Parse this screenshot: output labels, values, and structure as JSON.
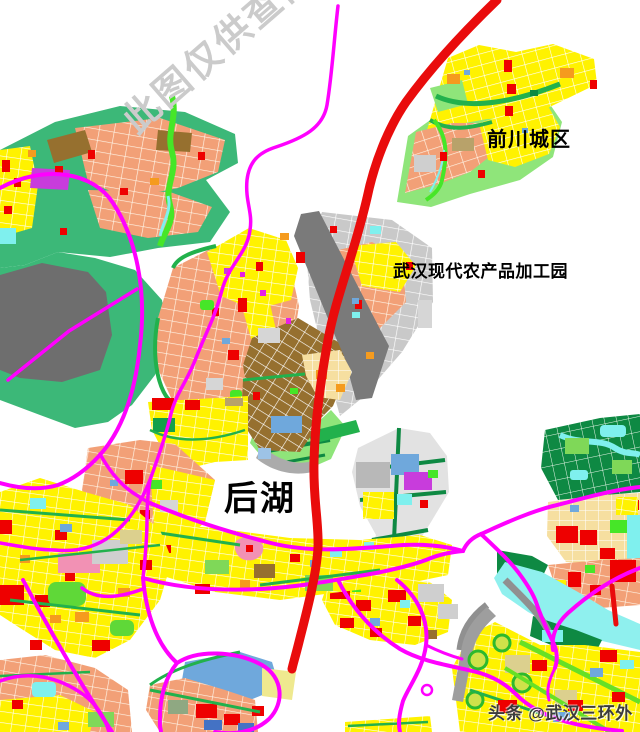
{
  "map": {
    "labels": {
      "qianchuan": "前川城区",
      "agri_park": "武汉现代农产品加工园",
      "houhu": "后湖"
    },
    "watermark": "此图仅供查阅",
    "attribution": "头条 @武汉三环外",
    "palette": {
      "ring_road_red": "#E90C0C",
      "road_magenta": "#FF00FF",
      "zone_salmon": "#F2A077",
      "zone_yellow": "#FFF200",
      "zone_brown": "#96702F",
      "zone_green": "#3CB878",
      "zone_bright_green": "#46E628",
      "zone_light_green": "#8FE57A",
      "zone_dark_green": "#0E8943",
      "zone_gray": "#C9C9C9",
      "zone_dark_gray": "#6E6E6E",
      "zone_water_cyan": "#7FF0EE",
      "zone_blue": "#6FA8DC",
      "zone_deep_blue": "#4472C4",
      "zone_red_block": "#EE0000",
      "zone_orange": "#F59B1E",
      "zone_purple": "#C83CDC",
      "zone_pink": "#F291B4",
      "zone_wheat": "#F6DFA0",
      "watermark_gray": "#CBCBCB",
      "attribution_dark": "#3C3C3C"
    }
  }
}
